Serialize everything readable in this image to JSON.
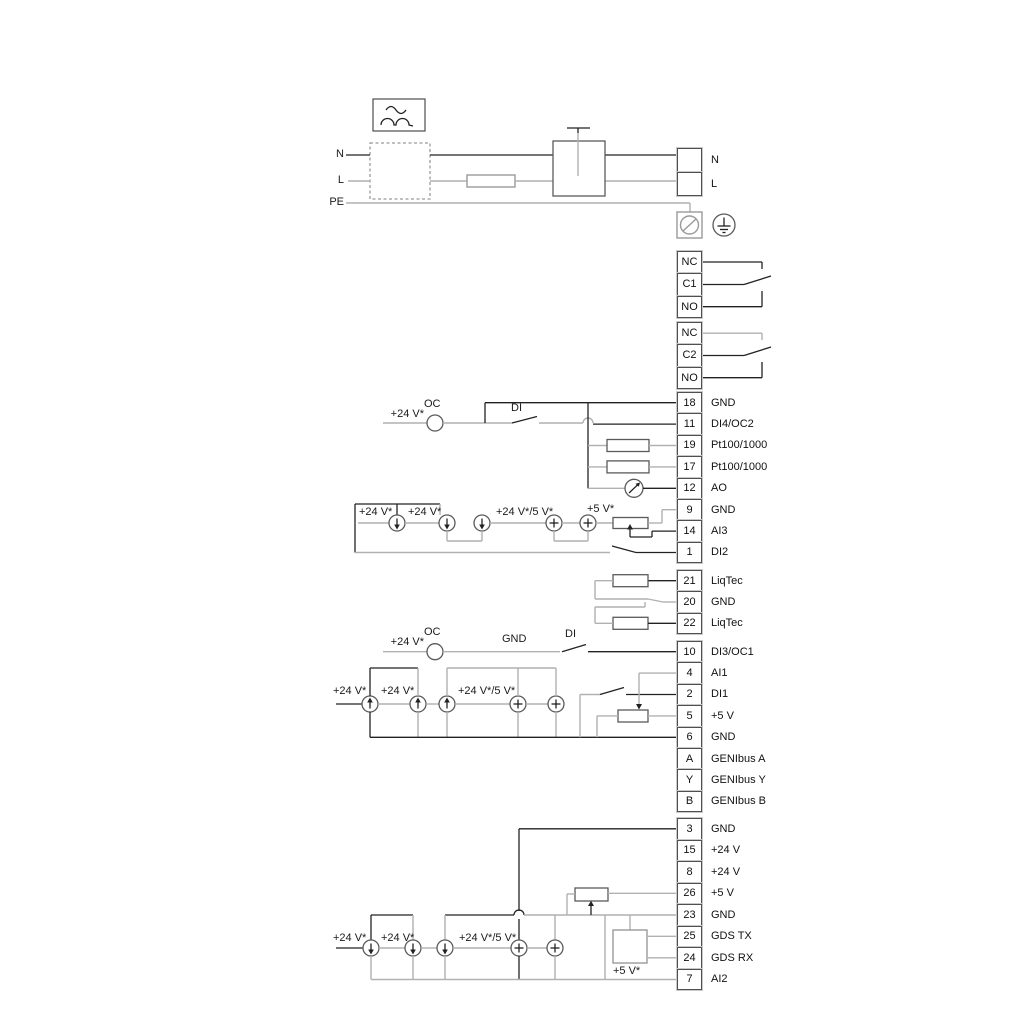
{
  "colors": {
    "wire": "#222222",
    "wire_secondary": "#b1b1b1"
  },
  "supply": {
    "n": "N",
    "l": "L",
    "pe": "PE"
  },
  "power_terminals": [
    {
      "id": "",
      "label": "N"
    },
    {
      "id": "",
      "label": "L"
    }
  ],
  "relay1": [
    {
      "id": "NC",
      "label": ""
    },
    {
      "id": "C1",
      "label": ""
    },
    {
      "id": "NO",
      "label": ""
    }
  ],
  "relay2": [
    {
      "id": "NC",
      "label": ""
    },
    {
      "id": "C2",
      "label": ""
    },
    {
      "id": "NO",
      "label": ""
    }
  ],
  "strip_a": [
    {
      "id": "18",
      "label": "GND"
    },
    {
      "id": "11",
      "label": "DI4/OC2"
    },
    {
      "id": "19",
      "label": "Pt100/1000"
    },
    {
      "id": "17",
      "label": "Pt100/1000"
    },
    {
      "id": "12",
      "label": "AO"
    },
    {
      "id": "9",
      "label": "GND"
    },
    {
      "id": "14",
      "label": "AI3"
    },
    {
      "id": "1",
      "label": "DI2"
    }
  ],
  "strip_b": [
    {
      "id": "21",
      "label": "LiqTec"
    },
    {
      "id": "20",
      "label": "GND"
    },
    {
      "id": "22",
      "label": "LiqTec"
    }
  ],
  "strip_c": [
    {
      "id": "10",
      "label": "DI3/OC1"
    },
    {
      "id": "4",
      "label": "AI1"
    },
    {
      "id": "2",
      "label": "DI1"
    },
    {
      "id": "5",
      "label": "+5 V"
    },
    {
      "id": "6",
      "label": "GND"
    },
    {
      "id": "A",
      "label": "GENIbus A"
    },
    {
      "id": "Y",
      "label": "GENIbus Y"
    },
    {
      "id": "B",
      "label": "GENIbus B"
    }
  ],
  "strip_d": [
    {
      "id": "3",
      "label": "GND"
    },
    {
      "id": "15",
      "label": "+24 V"
    },
    {
      "id": "8",
      "label": "+24 V"
    },
    {
      "id": "26",
      "label": "+5 V"
    },
    {
      "id": "23",
      "label": "GND"
    },
    {
      "id": "25",
      "label": "GDS TX"
    },
    {
      "id": "24",
      "label": "GDS RX"
    },
    {
      "id": "7",
      "label": "AI2"
    }
  ],
  "ann": {
    "oc1": "OC",
    "v24_oc1": "+24 V*",
    "di1": "DI",
    "a1": "+24 V*",
    "a2": "+24 V*",
    "a3": "+24 V*/5 V*",
    "a4": "+5 V*",
    "oc2": "OC",
    "v24_oc2": "+24 V*",
    "gnd_mid": "GND",
    "di2": "DI",
    "m1": "+24 V*",
    "m2": "+24 V*",
    "m3": "+24 V*/5 V*",
    "b1": "+24 V*",
    "b2": "+24 V*",
    "b3": "+24 V*/5 V*",
    "b4": "+5 V*"
  }
}
